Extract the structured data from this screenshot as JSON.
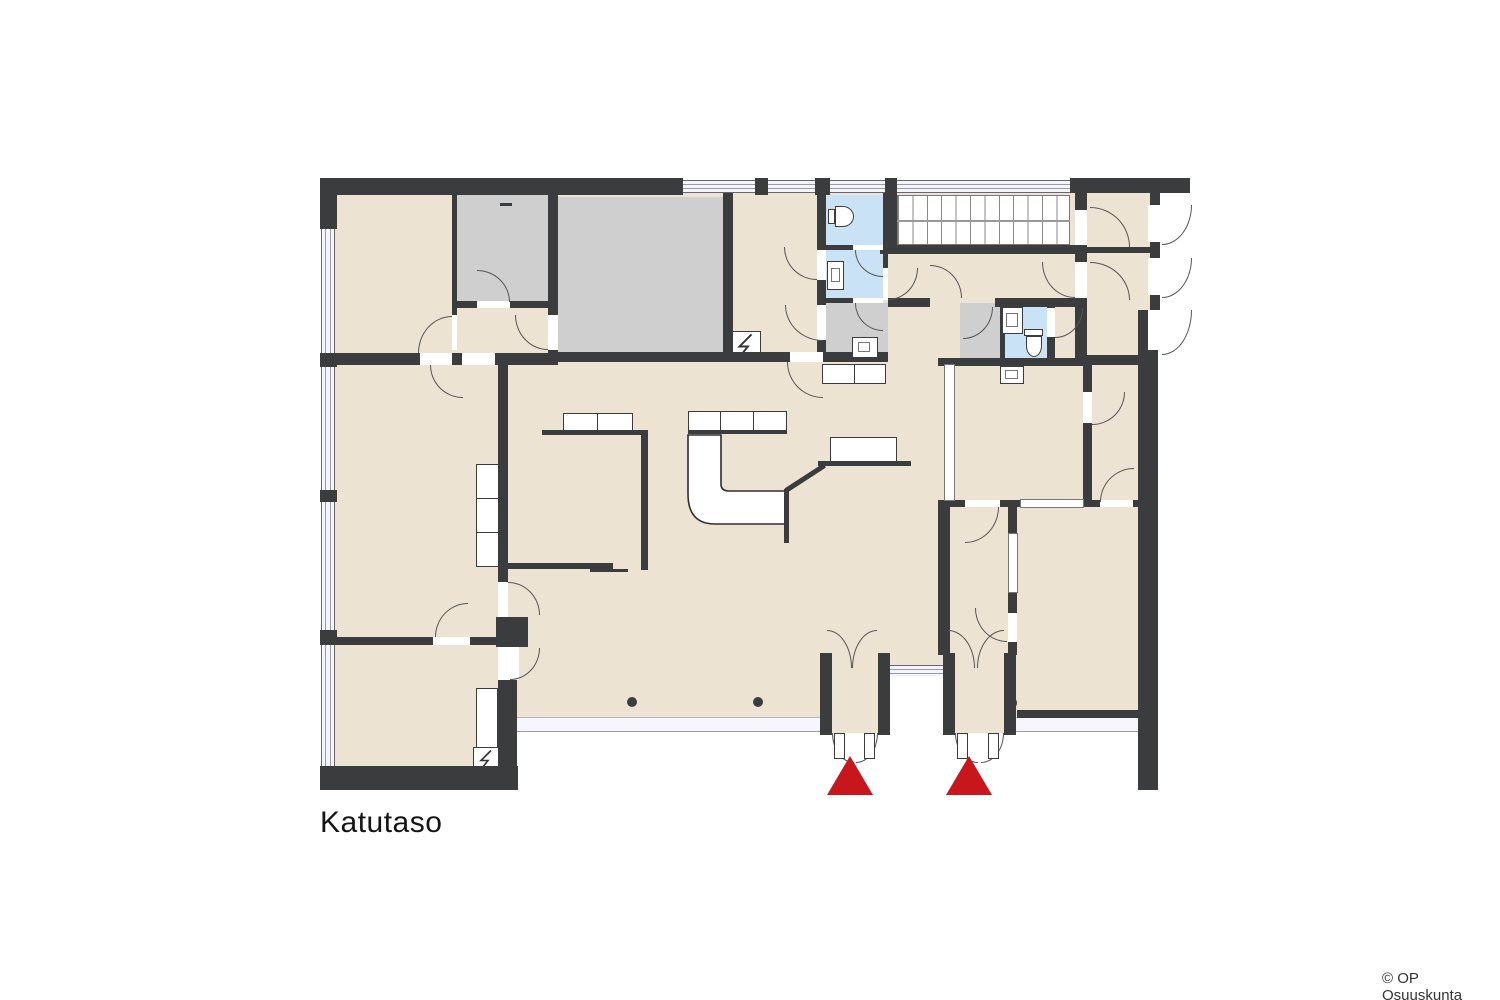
{
  "header": {
    "title": "Katutaso"
  },
  "footer": {
    "copyright": "© OP Osuuskunta"
  },
  "colors": {
    "background": "#ffffff",
    "floor": "#ece3d3",
    "wall": "#3b3c3e",
    "room_gray": "#cfcfcf",
    "bath_blue": "#c9e2f5",
    "window_glass": "#f4f4fb",
    "entrance_red": "#c8161d",
    "line": "#555555"
  },
  "markers": {
    "entrance_arrow_count": 2
  },
  "icons": {
    "entrance-arrow": "red-triangle-up",
    "toilet": "rounded-bowl-outline",
    "sink": "rect-basin-outline",
    "stairs": "parallel-tread-lines",
    "electrical-panel": "zigzag-bolt",
    "door-swing": "quarter-circle-arc",
    "column": "black-dot",
    "window": "triple-line-glass"
  }
}
